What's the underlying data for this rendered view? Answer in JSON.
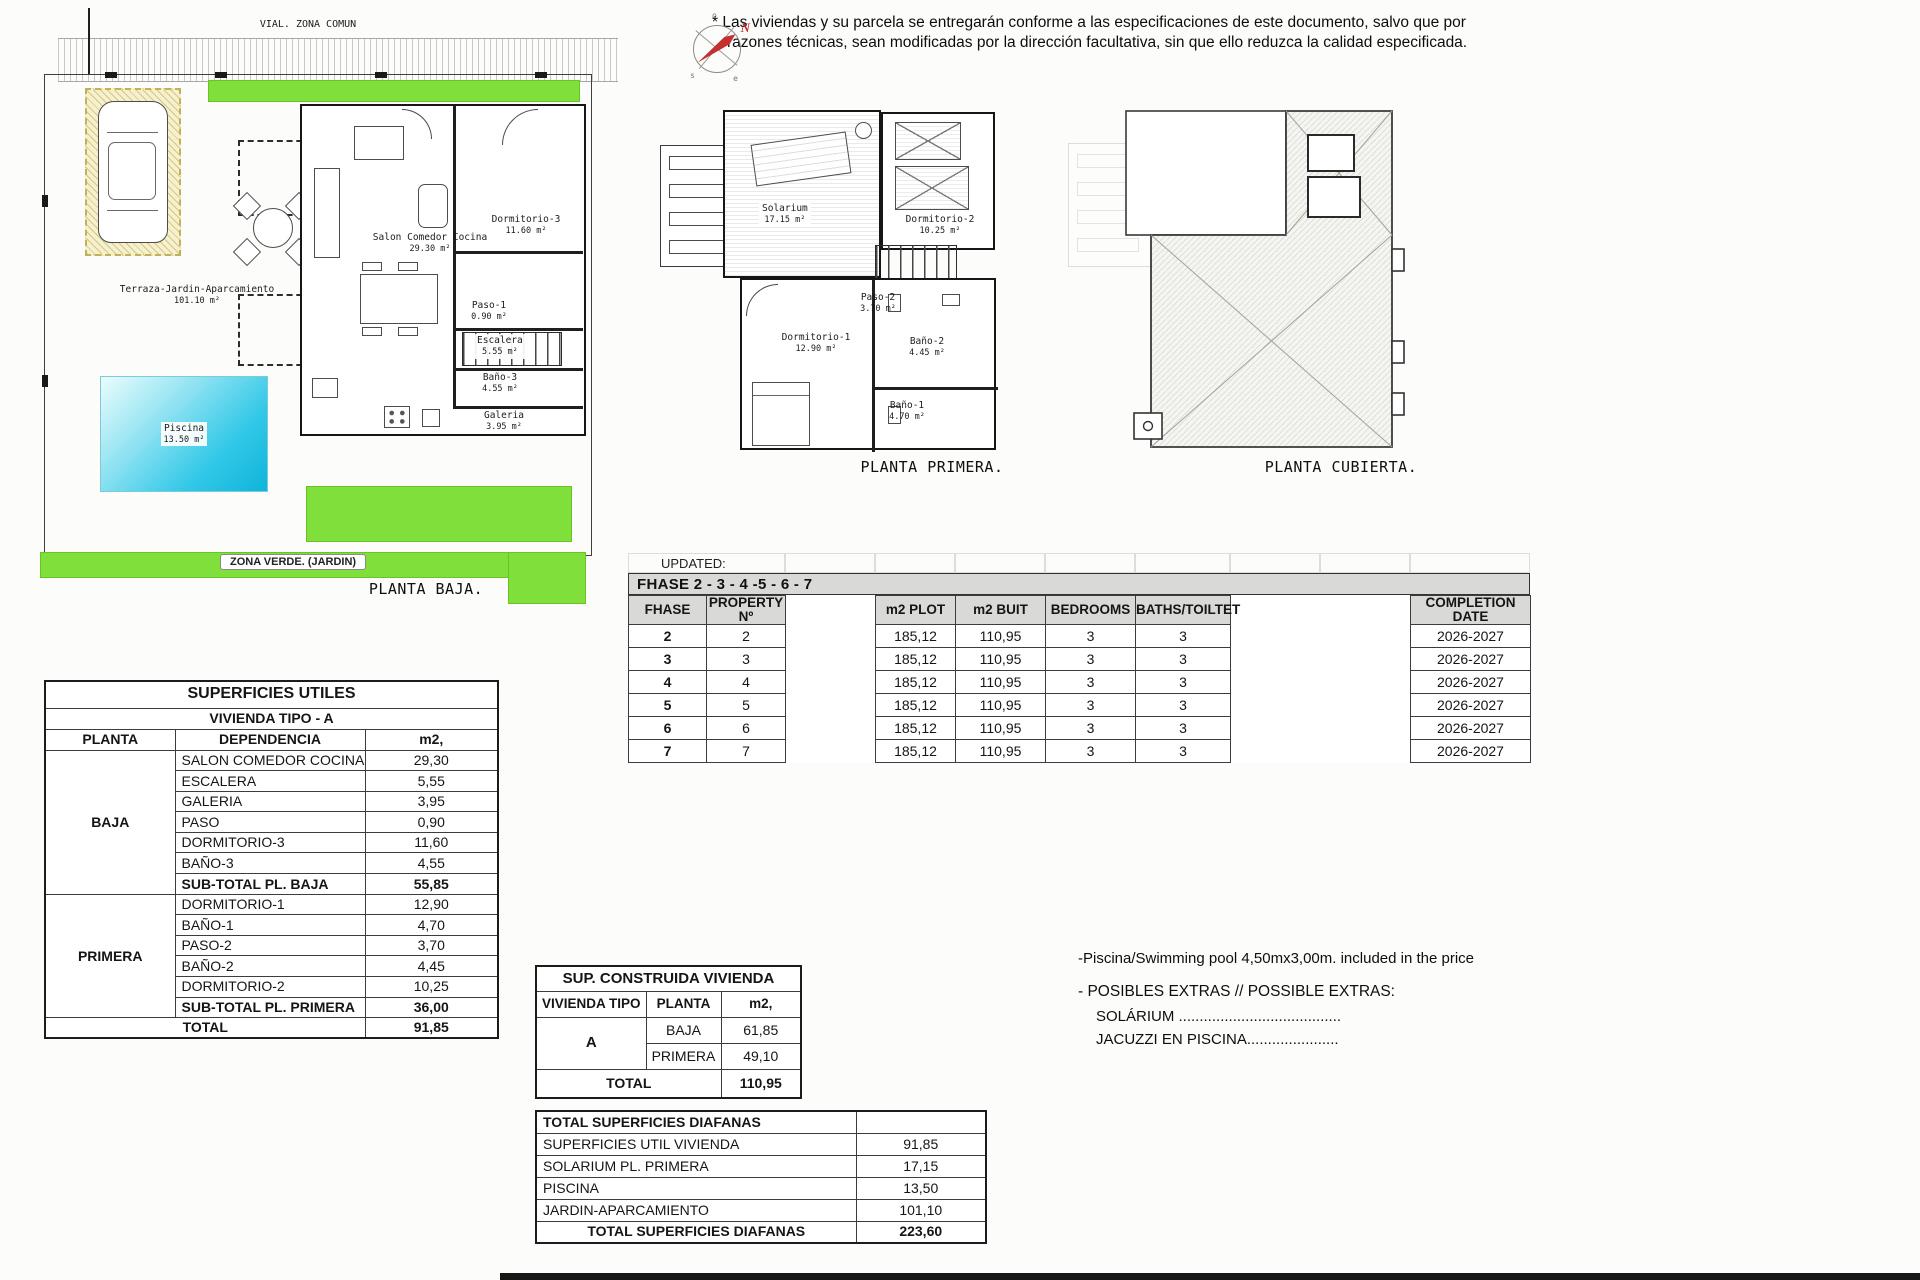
{
  "disclaimer": {
    "line1": "* Las viviendas y su parcela se entregarán conforme a las especificaciones de este documento, salvo que por",
    "line2": "razones técnicas, sean modificadas por la dirección facultativa, sin que ello reduzca la calidad especificada."
  },
  "compass": {
    "n": "N",
    "o": "o",
    "s": "s",
    "e": "e"
  },
  "plans": {
    "baja": {
      "caption": "PLANTA BAJA.",
      "vial": "VIAL. ZONA COMUN",
      "zona_verde": "ZONA VERDE. (JARDIN)",
      "terraza_name": "Terraza-Jardin-Aparcamiento",
      "terraza_area": "101.10 m²",
      "piscina_name": "Piscina",
      "piscina_area": "13.50 m²",
      "rooms": [
        {
          "name": "Salon Comedor Cocina",
          "area": "29.30 m²"
        },
        {
          "name": "Dormitorio-3",
          "area": "11.60 m²"
        },
        {
          "name": "Paso-1",
          "area": "0.90 m²"
        },
        {
          "name": "Escalera",
          "area": "5.55 m²"
        },
        {
          "name": "Baño-3",
          "area": "4.55 m²"
        },
        {
          "name": "Galeria",
          "area": "3.95 m²"
        }
      ]
    },
    "primera": {
      "caption": "PLANTA PRIMERA.",
      "rooms": [
        {
          "name": "Solarium",
          "area": "17.15 m²"
        },
        {
          "name": "Dormitorio-2",
          "area": "10.25 m²"
        },
        {
          "name": "Paso-2",
          "area": "3.70 m²"
        },
        {
          "name": "Dormitorio-1",
          "area": "12.90 m²"
        },
        {
          "name": "Baño-2",
          "area": "4.45 m²"
        },
        {
          "name": "Baño-1",
          "area": "4.70 m²"
        }
      ]
    },
    "cubierta": {
      "caption": "PLANTA CUBIERTA."
    }
  },
  "fhase_table": {
    "updated": "UPDATED: 15/09/2025",
    "title": "FHASE  2 - 3 - 4 -5 - 6 - 7",
    "headers": {
      "fhase": "FHASE",
      "property": "PROPERTY Nº",
      "plot": "m2 PLOT",
      "built": "m2 BUIT",
      "bedrooms": "BEDROOMS",
      "baths": "BATHS/TOILTET",
      "completion": "COMPLETION DATE"
    },
    "rows": [
      {
        "fhase": "2",
        "property": "2",
        "plot": "185,12",
        "built": "110,95",
        "bedrooms": "3",
        "baths": "3",
        "completion": "2026-2027"
      },
      {
        "fhase": "3",
        "property": "3",
        "plot": "185,12",
        "built": "110,95",
        "bedrooms": "3",
        "baths": "3",
        "completion": "2026-2027"
      },
      {
        "fhase": "4",
        "property": "4",
        "plot": "185,12",
        "built": "110,95",
        "bedrooms": "3",
        "baths": "3",
        "completion": "2026-2027"
      },
      {
        "fhase": "5",
        "property": "5",
        "plot": "185,12",
        "built": "110,95",
        "bedrooms": "3",
        "baths": "3",
        "completion": "2026-2027"
      },
      {
        "fhase": "6",
        "property": "6",
        "plot": "185,12",
        "built": "110,95",
        "bedrooms": "3",
        "baths": "3",
        "completion": "2026-2027"
      },
      {
        "fhase": "7",
        "property": "7",
        "plot": "185,12",
        "built": "110,95",
        "bedrooms": "3",
        "baths": "3",
        "completion": "2026-2027"
      }
    ]
  },
  "superficies_table": {
    "title": "SUPERFICIES UTILES",
    "subtitle": "VIVIENDA TIPO - A",
    "headers": {
      "planta": "PLANTA",
      "dependencia": "DEPENDENCIA",
      "m2": "m2,"
    },
    "baja_label": "BAJA",
    "baja_rows": [
      {
        "dep": "SALON COMEDOR COCINA",
        "m2": "29,30"
      },
      {
        "dep": "ESCALERA",
        "m2": "5,55"
      },
      {
        "dep": "GALERIA",
        "m2": "3,95"
      },
      {
        "dep": "PASO",
        "m2": "0,90"
      },
      {
        "dep": "DORMITORIO-3",
        "m2": "11,60"
      },
      {
        "dep": "BAÑO-3",
        "m2": "4,55"
      }
    ],
    "baja_subtotal": {
      "dep": "SUB-TOTAL PL. BAJA",
      "m2": "55,85"
    },
    "primera_label": "PRIMERA",
    "primera_rows": [
      {
        "dep": "DORMITORIO-1",
        "m2": "12,90"
      },
      {
        "dep": "BAÑO-1",
        "m2": "4,70"
      },
      {
        "dep": "PASO-2",
        "m2": "3,70"
      },
      {
        "dep": "BAÑO-2",
        "m2": "4,45"
      },
      {
        "dep": "DORMITORIO-2",
        "m2": "10,25"
      }
    ],
    "primera_subtotal": {
      "dep": "SUB-TOTAL PL. PRIMERA",
      "m2": "36,00"
    },
    "total": {
      "label": "TOTAL",
      "m2": "91,85"
    }
  },
  "construida_table": {
    "title": "SUP. CONSTRUIDA VIVIENDA",
    "headers": {
      "tipo": "VIVIENDA TIPO",
      "planta": "PLANTA",
      "m2": "m2,"
    },
    "tipo_value": "A",
    "rows": [
      {
        "planta": "BAJA",
        "m2": "61,85"
      },
      {
        "planta": "PRIMERA",
        "m2": "49,10"
      }
    ],
    "total": {
      "label": "TOTAL",
      "m2": "110,95"
    }
  },
  "diafanas_table": {
    "title": "TOTAL SUPERFICIES DIAFANAS",
    "rows": [
      {
        "label": "SUPERFICIES UTIL VIVIENDA",
        "m2": "91,85"
      },
      {
        "label": "SOLARIUM PL. PRIMERA",
        "m2": "17,15"
      },
      {
        "label": "PISCINA",
        "m2": "13,50"
      },
      {
        "label": "JARDIN-APARCAMIENTO",
        "m2": "101,10"
      }
    ],
    "total": {
      "label": "TOTAL SUPERFICIES DIAFANAS",
      "m2": "223,60"
    }
  },
  "notes": {
    "pool": "-Piscina/Swimming pool 4,50mx3,00m. included in the price",
    "extras_title": "- POSIBLES EXTRAS // POSSIBLE EXTRAS:",
    "extra1": "SOLÁRIUM .......................................",
    "extra2": "JACUZZI EN PISCINA......................"
  },
  "colors": {
    "green": "#80df3b",
    "pool": "#2ec8e8",
    "header_gray": "#d9d9d7",
    "needle_red": "#c4302e"
  }
}
